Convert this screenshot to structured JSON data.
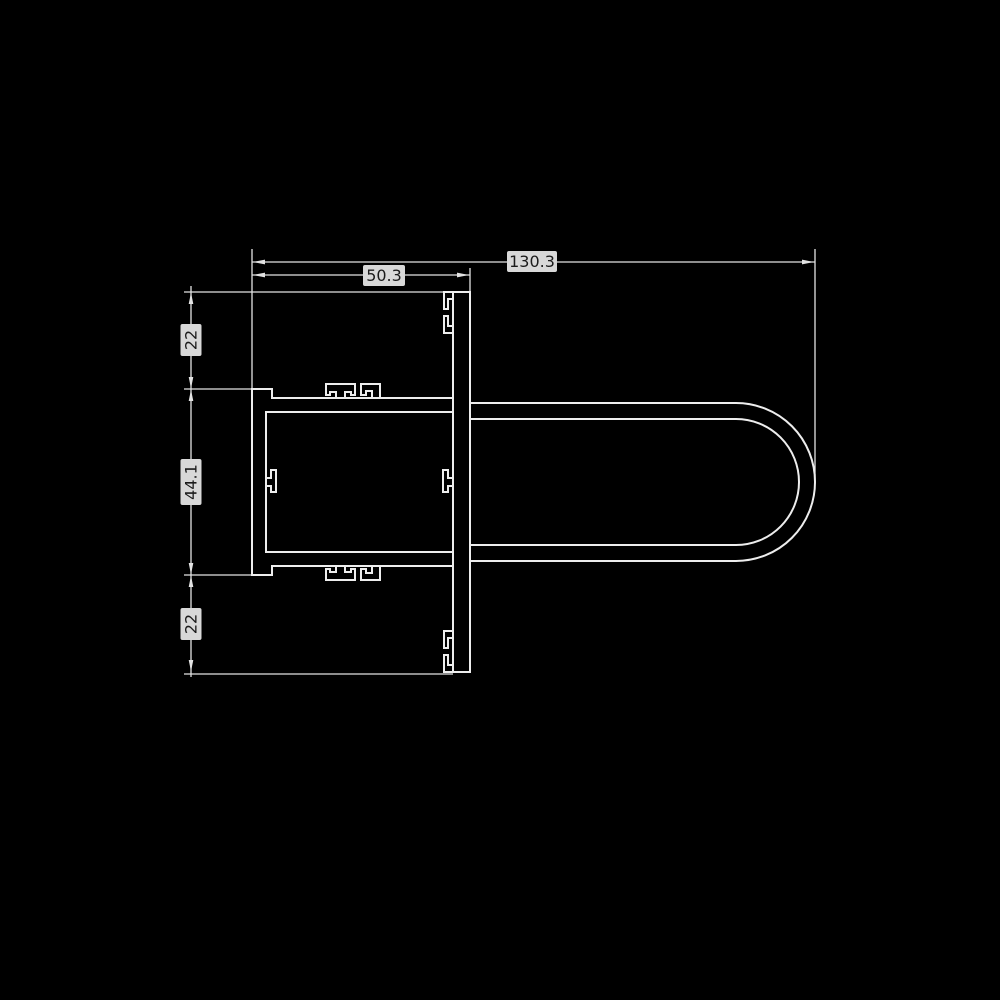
{
  "colors": {
    "background": "#000000",
    "dimension_line": "#e3e3e3",
    "profile_outline": "#ededed",
    "profile_fill": "#000000",
    "label_background": "#d8d8d8",
    "label_text": "#1b1b1b"
  },
  "dimensions": {
    "total_width": "130.3",
    "box_width": "50.3",
    "top_height": "22",
    "middle_height": "44.1",
    "bottom_height": "22"
  }
}
